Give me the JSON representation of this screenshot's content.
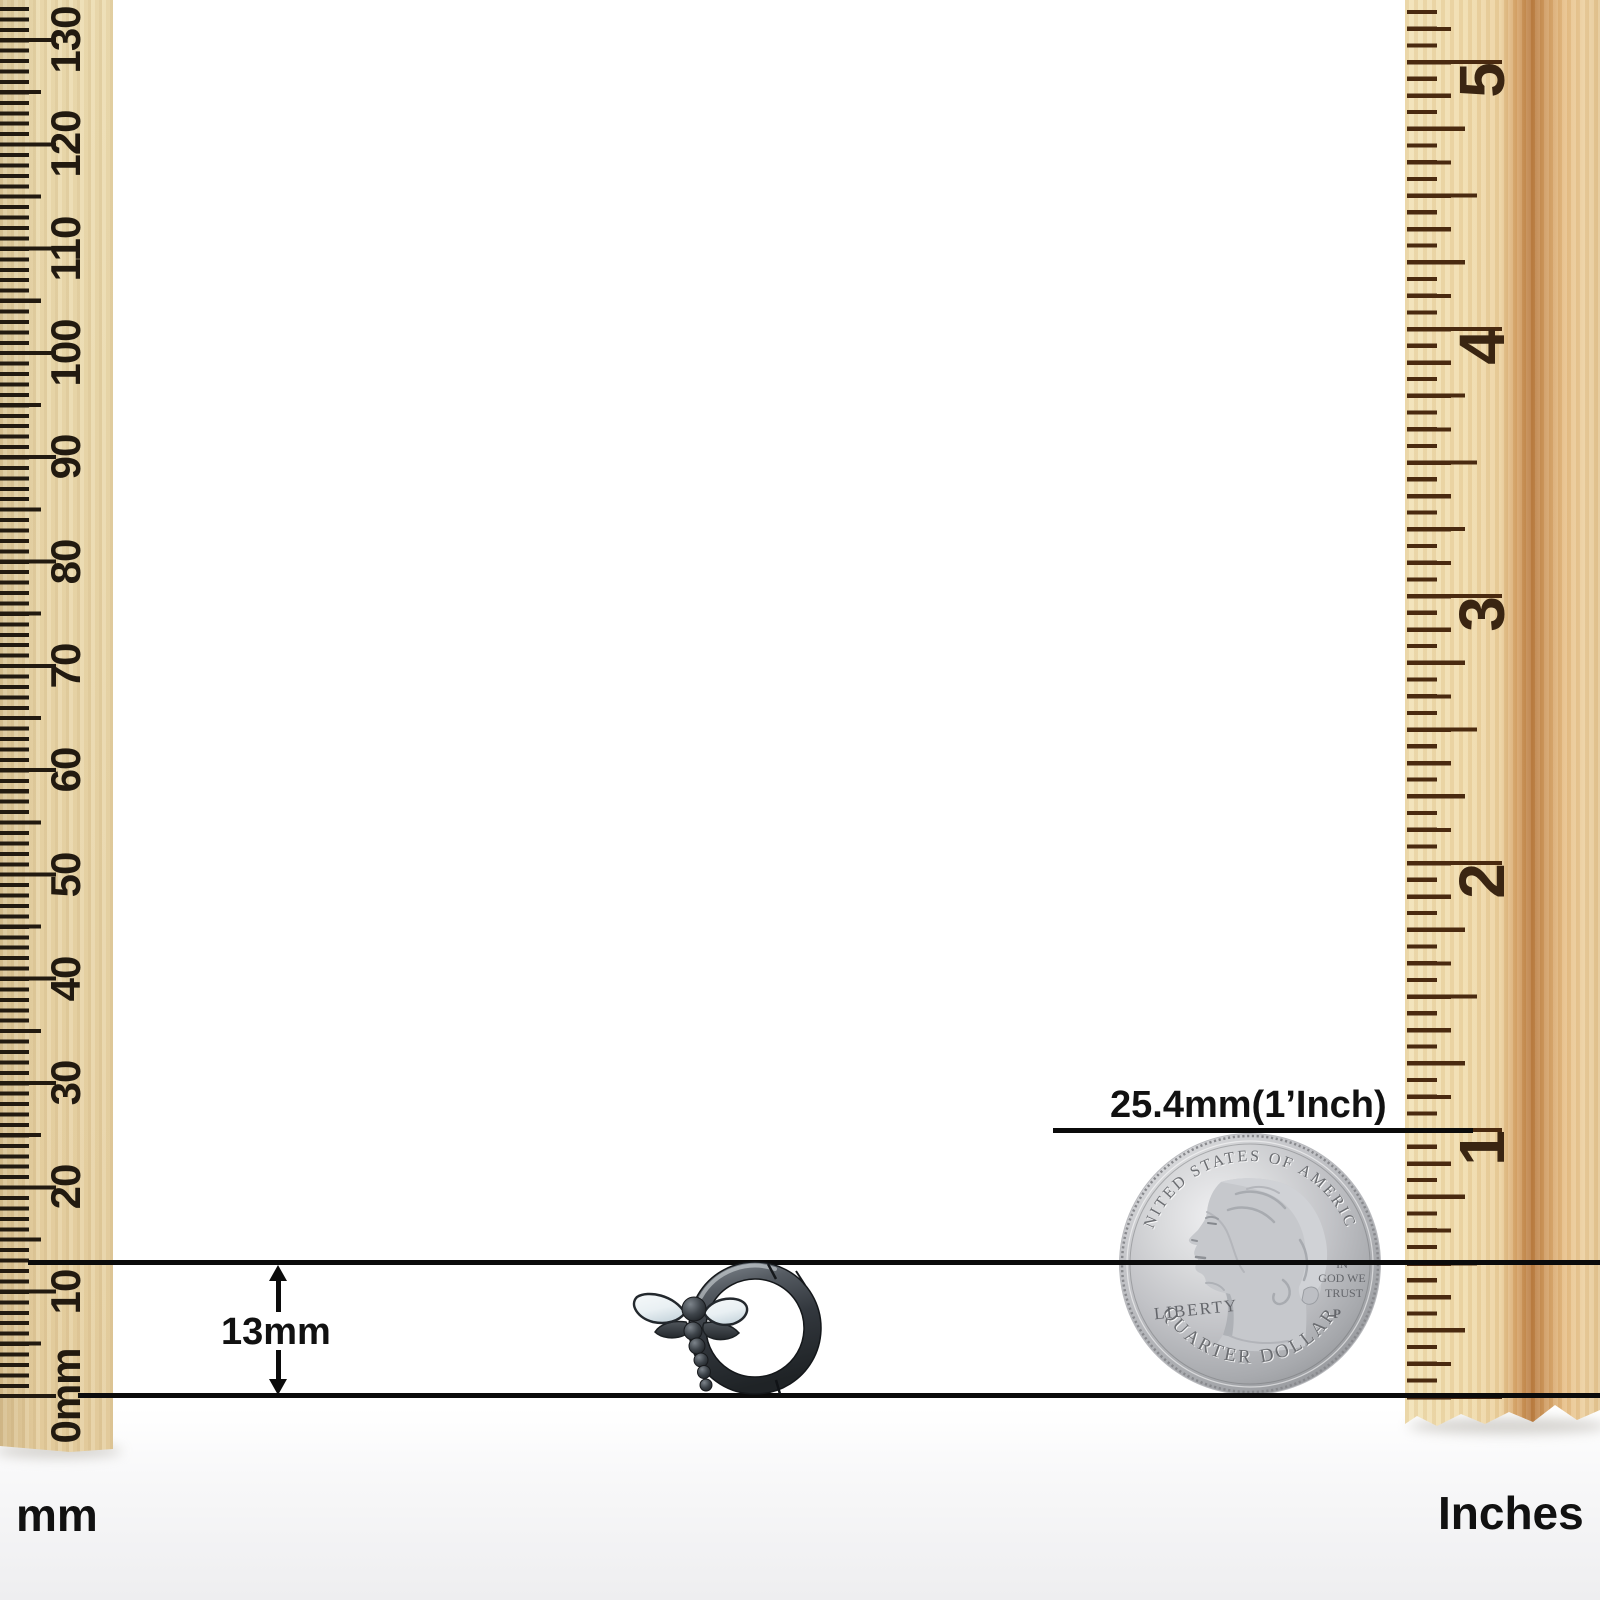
{
  "left_ruler": {
    "unit_label": "mm",
    "labels": [
      "0mm",
      "10",
      "20",
      "30",
      "40",
      "50",
      "60",
      "70",
      "80",
      "90",
      "100",
      "110",
      "120",
      "130"
    ]
  },
  "right_ruler": {
    "unit_label": "Inches",
    "labels": [
      "1",
      "2",
      "3",
      "4",
      "5"
    ]
  },
  "annotations": {
    "item_height": "13mm",
    "coin_size": "25.4mm(1’Inch)"
  },
  "coin": {
    "legend_top": "UNITED STATES OF AMERICA",
    "legend_bottom": "QUARTER DOLLAR",
    "liberty": "LIBERTY",
    "motto_line1": "IN",
    "motto_line2": "GOD WE",
    "motto_line3": "TRUST",
    "mint_mark": "P"
  },
  "colors": {
    "measure_line": "#0b0b0b",
    "text_dark": "#111111",
    "wood_left": "#ecdcb0",
    "wood_grain_dark": "#b87a3f",
    "tick_left": "#221a10",
    "tick_right": "#4a2a10",
    "coin_text": "#6b6d71",
    "earring_metal": "#33383e",
    "wing_white": "#eef3f5"
  }
}
